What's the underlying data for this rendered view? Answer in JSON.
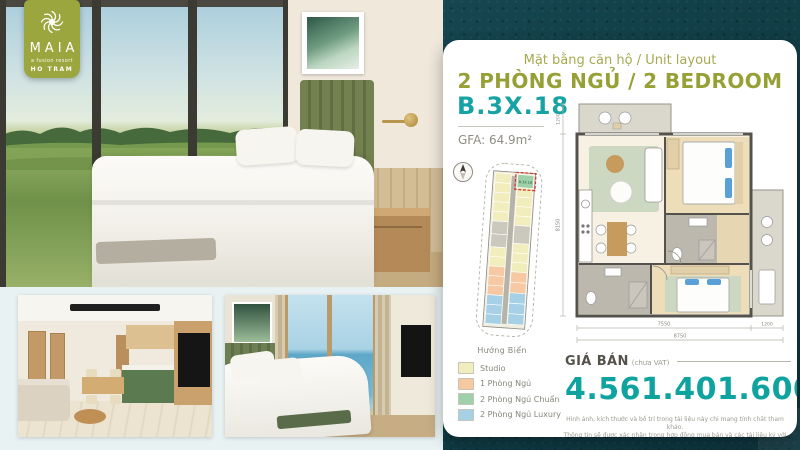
{
  "brand": {
    "name": "MAIA",
    "tagline": "a fusion resort",
    "location": "HO TRAM"
  },
  "header": {
    "subtitle": "Mặt bằng căn hộ / Unit layout",
    "title": "2 PHÒNG NGỦ / 2 BEDROOM"
  },
  "unit": {
    "code": "B.3X.18",
    "gfa": "GFA: 64.9m²"
  },
  "keyplan": {
    "direction": "Hướng Biển",
    "highlight_label": "B.3X.18"
  },
  "legend": {
    "items": [
      {
        "label": "Studio",
        "color": "#f2edbc"
      },
      {
        "label": "1 Phòng Ngủ",
        "color": "#f6c9a2"
      },
      {
        "label": "2 Phòng Ngủ Chuẩn",
        "color": "#9ed0a9"
      },
      {
        "label": "2 Phòng Ngủ Luxury",
        "color": "#a6d0e6"
      }
    ]
  },
  "floorplan": {
    "dims": {
      "top_height": "1200",
      "left_height": "8150",
      "main_width": "7550",
      "balcony_width": "1200",
      "total_width": "8750"
    }
  },
  "price": {
    "label": "GIÁ BÁN",
    "note": "(chưa VAT)",
    "value": "4.561.401.600"
  },
  "disclaimer": {
    "line1": "Hình ảnh, kích thước và bố trí trong tài liệu này chỉ mang tính chất tham khảo.",
    "line2": "Thông tin sẽ được xác nhận trong hợp đồng mua bán và các tài liệu ký với khách hàng."
  },
  "colors": {
    "accent_teal": "#0ea39e",
    "accent_olive": "#96a035",
    "badge_green": "#9ba63e"
  }
}
